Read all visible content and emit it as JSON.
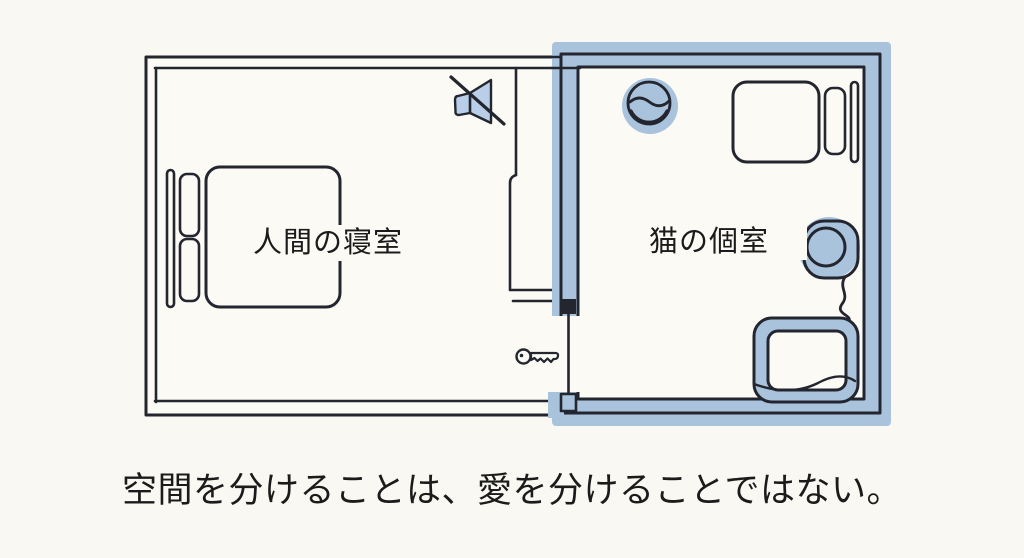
{
  "illustration": {
    "caption": "空間を分けることは、愛を分けることではない。",
    "rooms": [
      {
        "id": "human-bedroom",
        "label": "人間の寝室"
      },
      {
        "id": "cat-room",
        "label": "猫の個室"
      }
    ],
    "icons": [
      "muted-speaker-icon",
      "key-icon",
      "door-leaf-icon",
      "human-bed-icon",
      "water-bowl-icon",
      "cat-bed-icon",
      "round-cat-bed-icon",
      "litter-box-icon"
    ],
    "colors": {
      "background": "#faf8f2",
      "room_floor": "#fbfaf5",
      "line": "#23262e",
      "wall_highlight": "#a9c3dd",
      "icon_fill": "#b9cee8",
      "text": "#1b1b1b"
    }
  }
}
